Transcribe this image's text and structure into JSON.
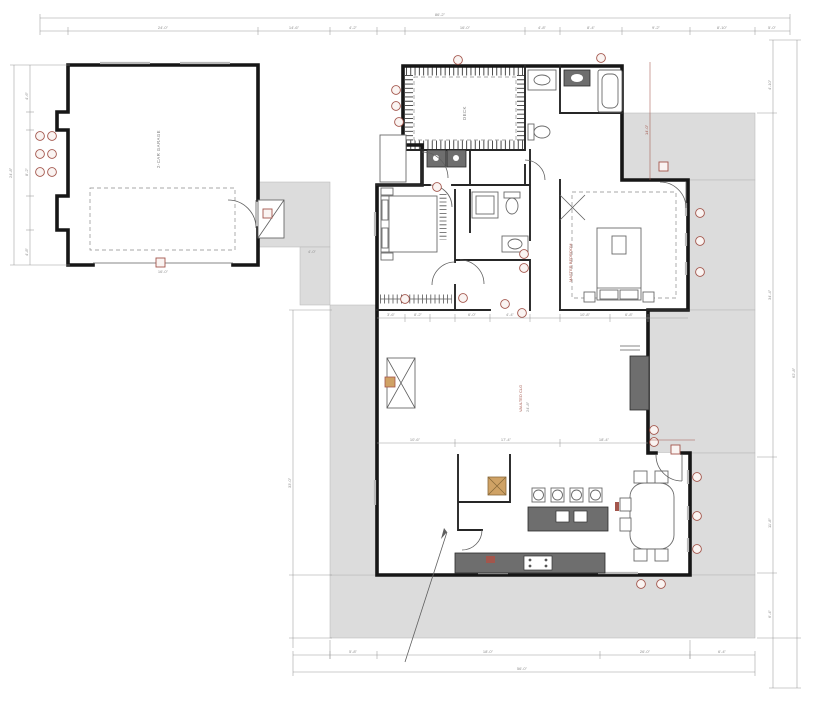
{
  "plan": {
    "dims": {
      "top_overall": "86'-2\"",
      "top": [
        "24'-0\"",
        "14'-6\"",
        "4'-2\"",
        "16'-0\"",
        "4'-8\"",
        "8'-4\"",
        "9'-2\"",
        "8'-10\"",
        "5'-0\""
      ],
      "garage_left_overall": "24'-8\"",
      "garage_left": [
        "4'-6\"",
        "8'-2\"",
        "4'-8\""
      ],
      "garage_door": "16'-0\"",
      "walkway": "4'-0\"",
      "left_main": "33'-0\"",
      "right_overall": "62'-8\"",
      "right": [
        "4'-10\"",
        "34'-4\"",
        "11'-8\"",
        "6'-4\""
      ],
      "bottom_overall": "56'-0\"",
      "bottom": [
        "5'-8\"",
        "18'-0\"",
        "26'-0\"",
        "6'-4\""
      ],
      "row1": [
        "3'-6\"",
        "8'-2\"",
        "6'-0\"",
        "4'-4\"",
        "10'-8\"",
        "6'-8\""
      ],
      "row2": [
        "10'-6\"",
        "17'-4\"",
        "18'-4\""
      ],
      "great_vert": "24'-8\"",
      "master_depth": "14'-0\""
    },
    "rooms": {
      "garage": "2-CAR GARAGE",
      "deck": "DECK",
      "master": "MASTER BEDROOM",
      "great": "VAULTED CLG"
    }
  }
}
